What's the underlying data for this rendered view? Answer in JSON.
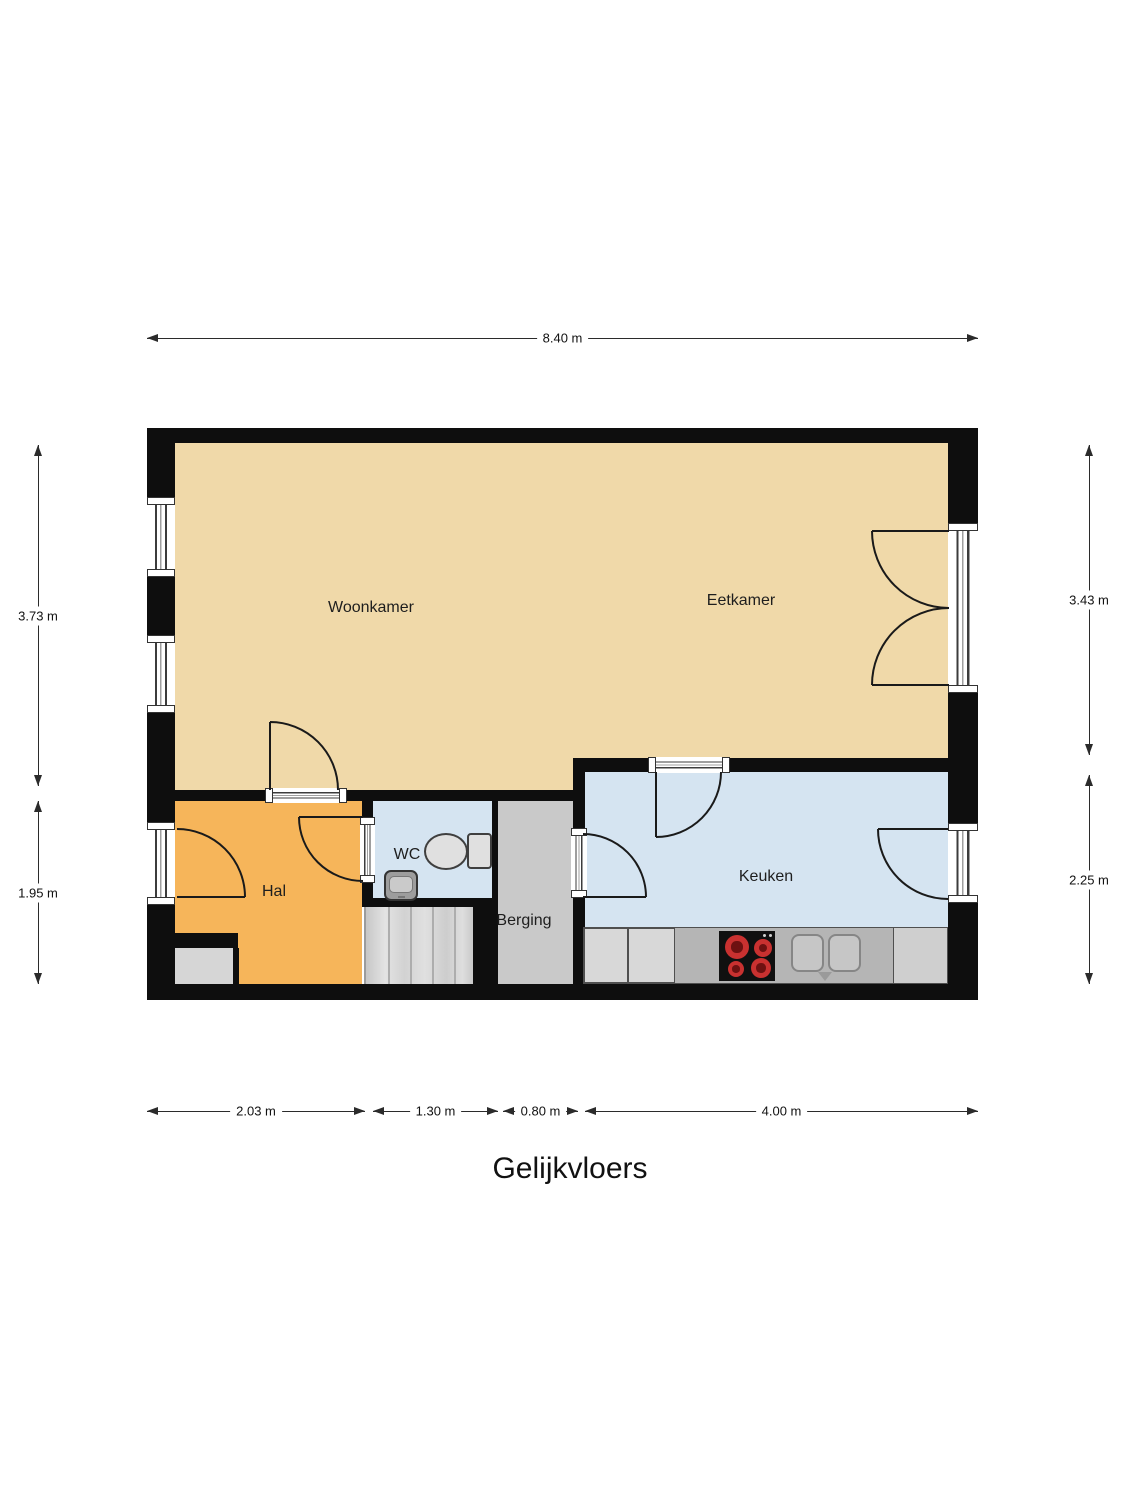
{
  "title": "Gelijkvloers",
  "floor_plan": {
    "rooms": {
      "woonkamer": {
        "label": "Woonkamer"
      },
      "eetkamer": {
        "label": "Eetkamer"
      },
      "hal": {
        "label": "Hal"
      },
      "wc": {
        "label": "WC"
      },
      "berging": {
        "label": "Berging"
      },
      "keuken": {
        "label": "Keuken"
      }
    },
    "dimensions": {
      "top": [
        {
          "label": "8.40 m"
        }
      ],
      "left": [
        {
          "label": "3.73 m"
        },
        {
          "label": "1.95 m"
        }
      ],
      "right": [
        {
          "label": "3.43 m"
        },
        {
          "label": "2.25 m"
        }
      ],
      "bottom": [
        {
          "label": "2.03 m"
        },
        {
          "label": "1.30 m"
        },
        {
          "label": "0.80 m"
        },
        {
          "label": "4.00 m"
        }
      ]
    },
    "colors": {
      "wall": "#0e0e0e",
      "living": "#f0d9a9",
      "hall": "#f6b55a",
      "wet": "#d5e4f1",
      "storage": "#c9c9c9",
      "counter": "#b5b5b5",
      "counterlight": "#d8d8d8",
      "counterright": "#cfcfcf",
      "burner": "#c93130",
      "fixture": "#e0e0e0"
    }
  }
}
